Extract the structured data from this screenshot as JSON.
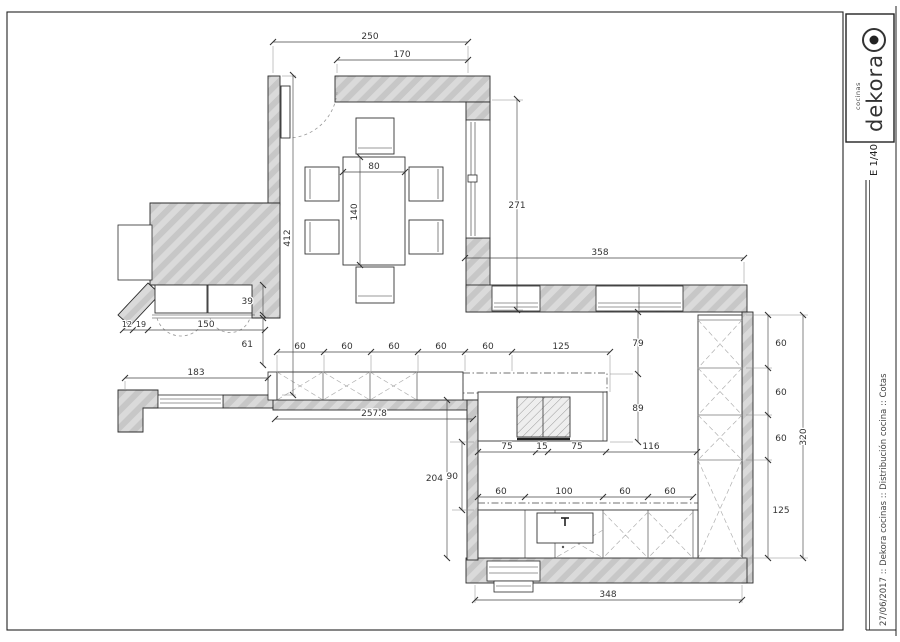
{
  "sheet": {
    "logo_brand": "dekora",
    "logo_sub": "cocinas",
    "scale_label": "E 1/40",
    "footer": "27/06/2017 :: Dekora cocinas :: Distribución cocina :: Cotas"
  },
  "dims": {
    "d250": "250",
    "d170": "170",
    "d80": "80",
    "d140": "140",
    "d412": "412",
    "d271": "271",
    "d358": "358",
    "d79": "79",
    "d89": "89",
    "d39": "39",
    "d12": "12",
    "d19": "19",
    "d150": "150",
    "d61": "61",
    "d183": "183",
    "d257_8": "257.8",
    "d204": "204",
    "d90": "90",
    "d320": "320",
    "d348": "348",
    "counter_run": [
      "60",
      "60",
      "60",
      "60",
      "60",
      "125"
    ],
    "island_run": [
      "75",
      "15",
      "75",
      "116"
    ],
    "bottom_run": [
      "60",
      "100",
      "60",
      "60"
    ],
    "right_run": [
      "60",
      "60",
      "60",
      "125"
    ]
  }
}
